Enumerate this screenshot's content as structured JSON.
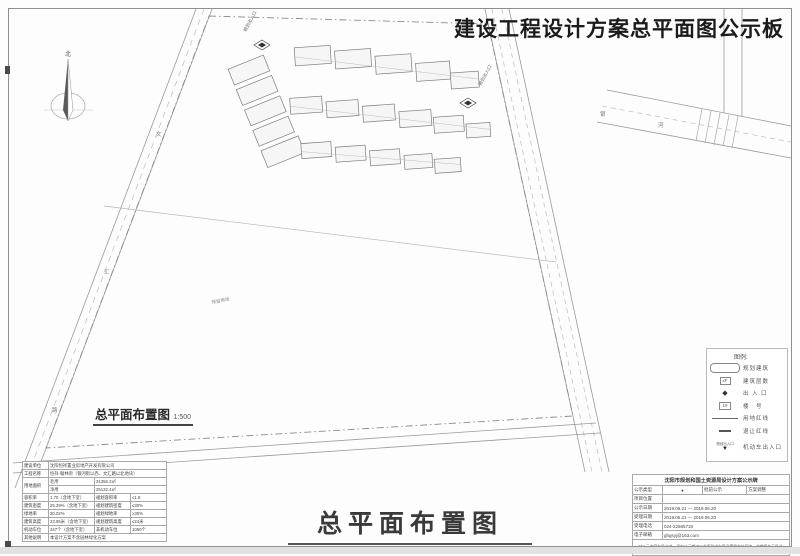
{
  "board": {
    "title": "建设工程设计方案总平面图公示板"
  },
  "main_title": {
    "text": "总平面布置图"
  },
  "plan": {
    "scale_label": "总平面布置图",
    "scale_value": "1:500",
    "north_label": "北",
    "parcel_label": "预留用地",
    "entrance_labels": [
      "规划出入口",
      "规划出入口"
    ],
    "road_chars": [
      "文",
      "汇",
      "路",
      "银",
      "河"
    ]
  },
  "legend": {
    "title": "图例:",
    "items": [
      {
        "type": "building",
        "label": "规划建筑"
      },
      {
        "type": "box",
        "symbol_text": "xF",
        "label": "建筑层数"
      },
      {
        "type": "entrance",
        "symbol_text": "◆",
        "label": "出 入 口"
      },
      {
        "type": "box",
        "symbol_text": "1#",
        "label": "楼　号"
      },
      {
        "type": "solid",
        "label": "用地红线"
      },
      {
        "type": "dash",
        "label": "退让红线"
      },
      {
        "type": "arrow",
        "symbol_text": "规划出入口",
        "label": "机动车出入口"
      }
    ]
  },
  "info_table": {
    "rows": [
      [
        "建设单位",
        "沈阳恒祥置业房地产开发有限公司"
      ],
      [
        "工程名称",
        "恒祥·翰林府（银河街以西、文汇路以北地块）"
      ],
      [
        "用地面积",
        "毛用",
        "31356.3㎡"
      ],
      [
        "净用",
        "25132.4㎡"
      ],
      [
        "容积率",
        "1.70（含地下室）",
        "规划容积率",
        "≤1.8"
      ],
      [
        "建筑密度",
        "25.29%（含地下室）",
        "规划建筑密度",
        "≤30%"
      ],
      [
        "绿地率",
        "30.02%",
        "规划绿地率",
        "≥30%"
      ],
      [
        "建筑高度",
        "23.95米（含地下室）",
        "规划建筑高度",
        "≤24米"
      ],
      [
        "机动车位",
        "347个（含地下室）",
        "非机动车位",
        "1050个"
      ],
      [
        "其他说明",
        "本设计方案不含园林绿化方案"
      ]
    ]
  },
  "notice_table": {
    "header": "沈阳市规划和国土资源局设计方案公示牌",
    "rows": [
      [
        "公示类型",
        "●",
        "批前公示",
        "方案调整"
      ],
      [
        "项目位置",
        ""
      ],
      [
        "公示日期",
        "2019.05.21 — 2019.06.20"
      ],
      [
        "受理日期",
        "2019.05.21 — 2019.06.20"
      ],
      [
        "受理电话",
        "024-22565718"
      ],
      [
        "电子邮箱",
        "ghgsyj@163.com"
      ]
    ],
    "note": "※ 对公示内容有异议者，请在公示期内以书面形式向意见受理单位反映，逾期视为无异议。"
  }
}
